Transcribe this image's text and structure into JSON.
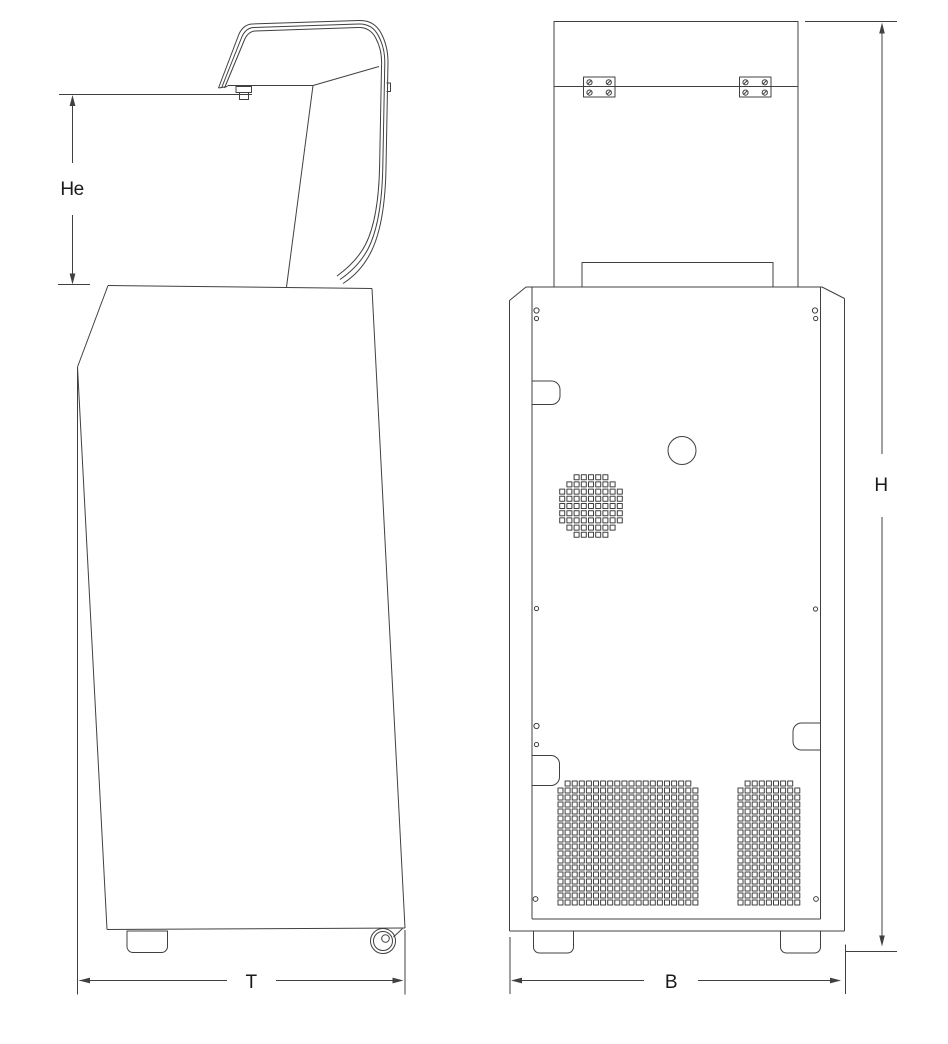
{
  "figure": {
    "type": "technical-dimension-drawing",
    "subject": "floor-standing centrifuge, lid open",
    "background": "#ffffff",
    "line_color": "#404040",
    "text_color": "#1a1a1a"
  },
  "side_view": {
    "dim_lid_height_label": "He",
    "dim_depth_label": "T"
  },
  "rear_view": {
    "dim_height_label": "H",
    "dim_width_label": "B"
  }
}
